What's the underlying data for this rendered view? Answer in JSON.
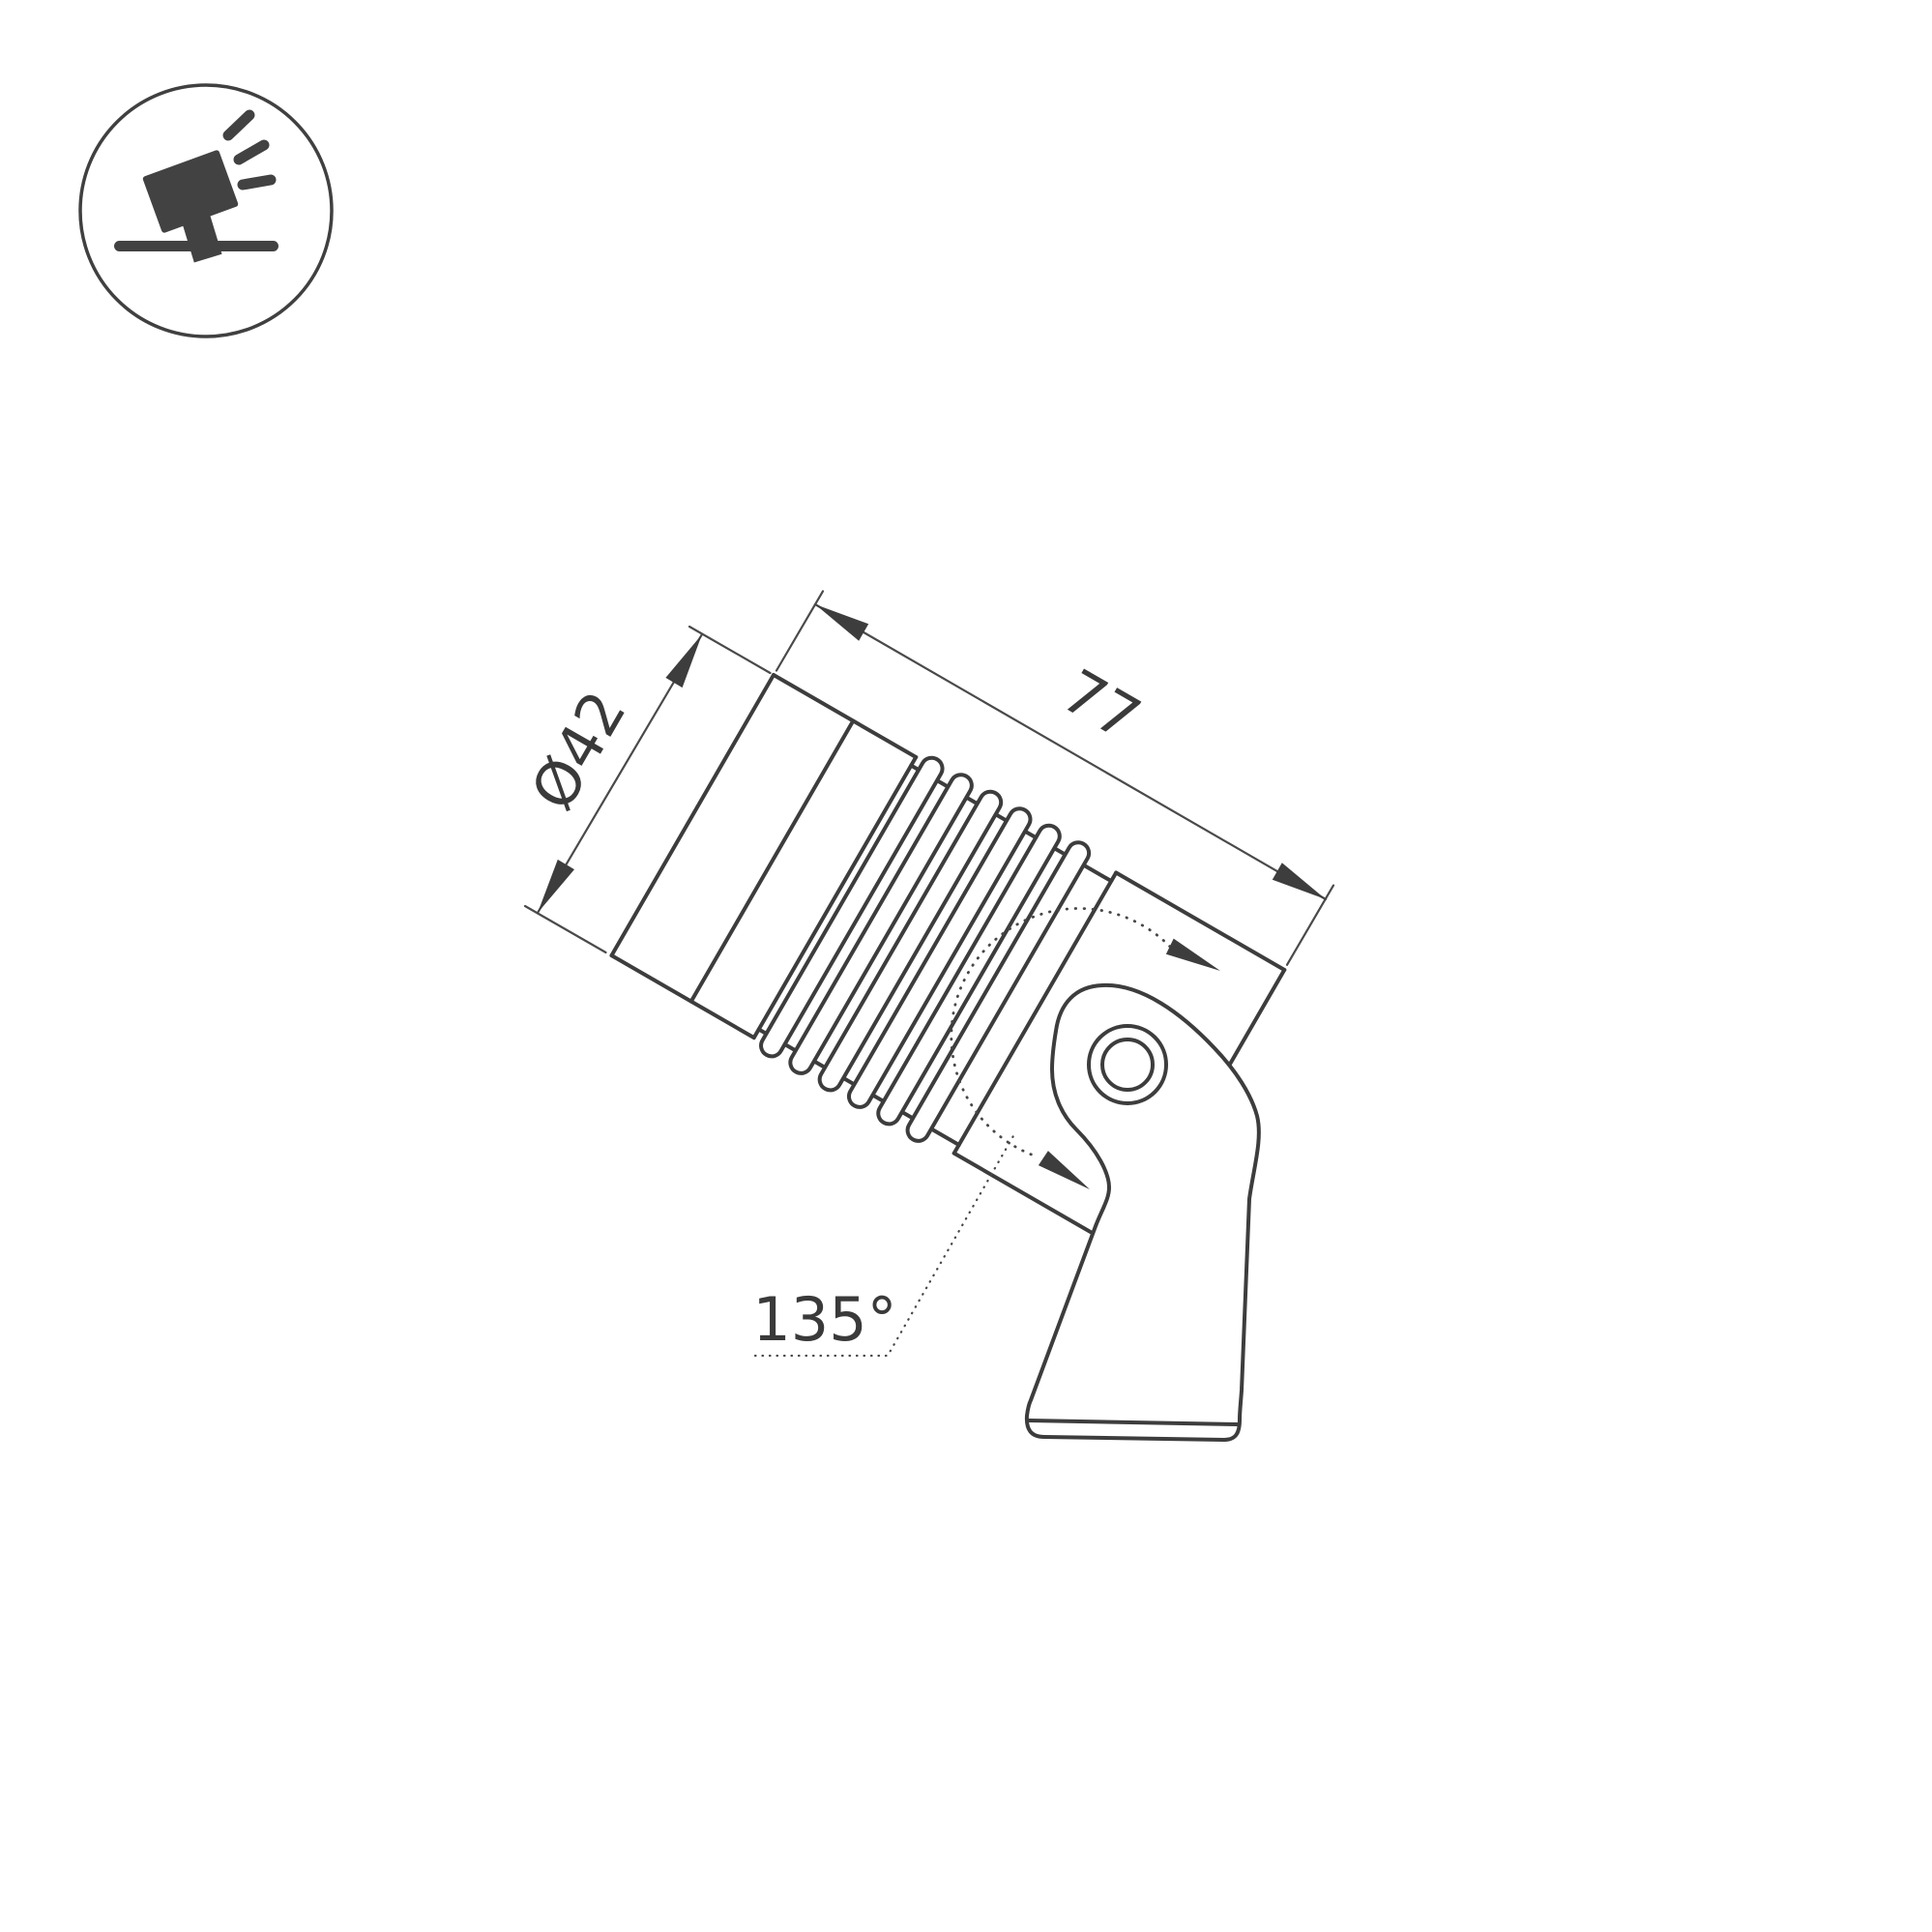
{
  "page": {
    "background": "#ffffff",
    "kind": "technical-dimension-drawing"
  },
  "icon": {
    "name": "tilted-spotlight-on-ground-icon",
    "color": "#424242"
  },
  "drawing": {
    "subject": "tilting anchor-mount spotlight, side view with fins, pivot bracket and base plate",
    "body_rotation_deg": 30,
    "labels": {
      "diameter": "Ø42",
      "length": "77",
      "rotation_angle": "135°"
    },
    "colors": {
      "object_line": "#3d3d3d",
      "dimension_line": "#4a4a4a",
      "text": "#3a3a3a"
    }
  }
}
